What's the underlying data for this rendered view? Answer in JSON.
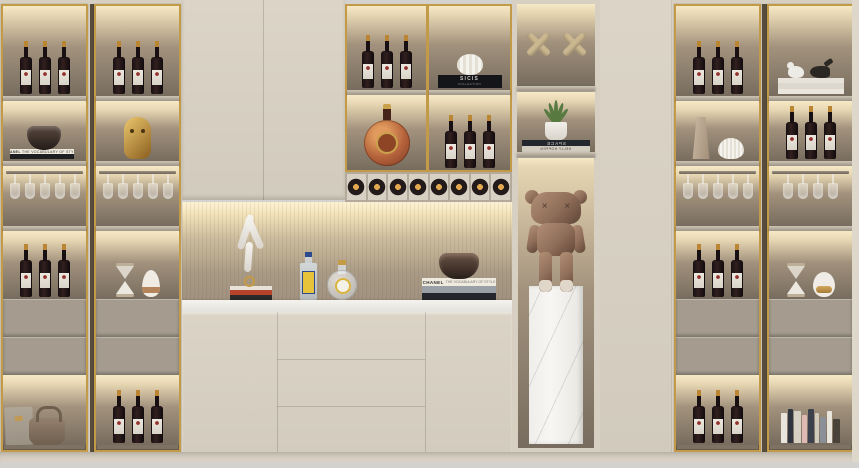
{
  "scene": {
    "description": "Built-in cream bar cabinet wall with brass-framed glass display columns, LED-lit shelves, wine bottles, hanging stemware, decor objects and a bronze companion figure on a marble plinth"
  },
  "colors": {
    "gold": "#c29a48",
    "cream": "#d7d0c2",
    "interior_light": "#f6e9c6",
    "interior": "#a2927d",
    "interior_dark": "#776c5e",
    "shelf": "#b5ab9d",
    "drawer": "#a59c8f",
    "marble": "#f4f3ef",
    "floor": "#d3d2ce",
    "wine": "#32201f",
    "label": "#ece8df",
    "capsule": "#bb8633",
    "bronze": "#8f6e5a",
    "wood": "#cab68f",
    "leaf": "#587a41"
  },
  "texts": {
    "sicis_title": "SICIS",
    "sicis_subtitle": "COLLECTION",
    "chanel_title": "CHANEL",
    "chanel_subtitle": "THE VOCABULARY OF STYLE",
    "space_title": "SPACE",
    "space_author": "KELLY HOPPEN"
  },
  "inventory": {
    "left_cabinet": {
      "column_1": [
        "3 red wine bottles",
        "stacked books with dark glass bowl",
        "hanging wine glasses",
        "3 red wine bottles",
        "2 drawers",
        "leather clutch and handbag"
      ],
      "column_2": [
        "3 red wine bottles",
        "gold mask sculpture",
        "hanging wine glasses",
        "hourglass and white vase",
        "2 drawers",
        "3 red wine bottles"
      ]
    },
    "center": {
      "upper_doors": "2 closed cabinet doors",
      "shelf_grid": [
        "3 red wine bottles",
        "white gourd ornament on SICIS book",
        "round cognac bottle",
        "3 red wine bottles"
      ],
      "wine_rack": "8 bottles stored horizontally",
      "counter_niche": [
        "white acrobat sculpture on books",
        "square spirit bottle with yellow label",
        "round flask bottle",
        "books with smoked glass bowl"
      ],
      "sideboard": "marble top, 2 doors, 3 center drawers"
    },
    "tall_display": [
      "two wooden X ornaments",
      "potted plant on SPACE books",
      "bronze companion figure on white marble plinth"
    ],
    "right_cabinet": {
      "column_1": [
        "3 red wine bottles",
        "beige folded vase and ribbed vase",
        "hanging wine glasses",
        "3 red wine bottles",
        "2 drawers",
        "3 red wine bottles"
      ],
      "column_2": [
        "bird figurines on books",
        "3 red wine bottles",
        "hanging wine glasses",
        "hourglass and gold-band vase",
        "2 drawers",
        "row of books"
      ]
    }
  }
}
